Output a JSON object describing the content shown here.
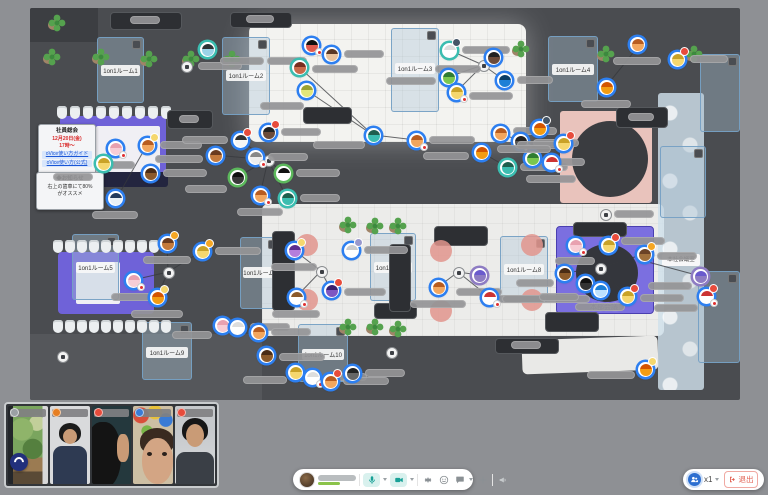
{
  "app": {
    "background": "#8e9094"
  },
  "map": {
    "floor_color": "#4a4c50",
    "rooms": [
      {
        "x": 67,
        "y": 29,
        "w": 45,
        "h": 64,
        "label": "1on1ルーム1"
      },
      {
        "x": 192,
        "y": 29,
        "w": 46,
        "h": 76,
        "label": "1on1ルーム2"
      },
      {
        "x": 361,
        "y": 20,
        "w": 46,
        "h": 82,
        "label": "1on1ルーム3"
      },
      {
        "x": 518,
        "y": 28,
        "w": 48,
        "h": 64,
        "label": "1on1ルーム4"
      },
      {
        "x": 42,
        "y": 226,
        "w": 45,
        "h": 64,
        "label": "1on1ルーム5"
      },
      {
        "x": 210,
        "y": 229,
        "w": 38,
        "h": 70,
        "label": "1on1ルーム6"
      },
      {
        "x": 340,
        "y": 225,
        "w": 44,
        "h": 66,
        "label": "1on1ルーム7"
      },
      {
        "x": 470,
        "y": 228,
        "w": 46,
        "h": 64,
        "label": "1on1ルーム8"
      },
      {
        "x": 112,
        "y": 314,
        "w": 48,
        "h": 56,
        "label": "1on1ルーム9"
      },
      {
        "x": 268,
        "y": 316,
        "w": 48,
        "h": 56,
        "label": "1on1ルーム10"
      },
      {
        "x": 670,
        "y": 46,
        "w": 38,
        "h": 76,
        "label": ""
      },
      {
        "x": 630,
        "y": 138,
        "w": 44,
        "h": 70,
        "label": ""
      },
      {
        "x": 668,
        "y": 263,
        "w": 40,
        "h": 90,
        "label": ""
      }
    ],
    "hq_room_label": "本社会議室",
    "meeting_label": "本部会議",
    "board1": {
      "l1": "社員総会",
      "l2": "12月20日(金)",
      "l3": "17時〜",
      "l4": "oVice使い方ガイド",
      "l5": "oVice使い方(公式)"
    },
    "board2": {
      "l1": "◆お知らせ",
      "l2": "右上の歯車にて80%",
      "l3": "がオススメ"
    },
    "plants": [
      [
        13,
        40
      ],
      [
        62,
        40
      ],
      [
        110,
        42
      ],
      [
        152,
        42
      ],
      [
        193,
        42
      ],
      [
        18,
        6
      ],
      [
        726,
        6
      ],
      [
        482,
        32
      ],
      [
        567,
        37
      ],
      [
        655,
        37
      ],
      [
        309,
        208
      ],
      [
        336,
        209
      ],
      [
        359,
        209
      ],
      [
        309,
        310
      ],
      [
        336,
        310
      ],
      [
        359,
        312
      ]
    ],
    "chair_rows": [
      [
        27,
        98,
        9,
        13
      ],
      [
        23,
        232,
        10,
        12
      ],
      [
        23,
        312,
        10,
        12
      ]
    ],
    "tables": [
      [
        80,
        4,
        70,
        16,
        20,
        4,
        30
      ],
      [
        200,
        4,
        60,
        14,
        16,
        3,
        28
      ],
      [
        137,
        102,
        44,
        17,
        12,
        5,
        20
      ],
      [
        273,
        99,
        47,
        15,
        0,
        0,
        0
      ],
      [
        586,
        99,
        50,
        19,
        12,
        6,
        26
      ],
      [
        543,
        214,
        52,
        13,
        0,
        0,
        0
      ],
      [
        404,
        218,
        52,
        18,
        0,
        0,
        0
      ],
      [
        344,
        295,
        41,
        14,
        0,
        0,
        0
      ],
      [
        515,
        304,
        52,
        18,
        0,
        0,
        0
      ],
      [
        465,
        330,
        62,
        14,
        16,
        3,
        30
      ],
      [
        242,
        223,
        21,
        78,
        0,
        0,
        0
      ],
      [
        359,
        236,
        20,
        66,
        0,
        0,
        0
      ]
    ],
    "pink_seats": [
      [
        266,
        226
      ],
      [
        266,
        281
      ],
      [
        400,
        232
      ],
      [
        400,
        292
      ],
      [
        491,
        226
      ],
      [
        491,
        281
      ]
    ],
    "spots": [
      [
        238,
        152
      ],
      [
        138,
        264
      ],
      [
        291,
        263
      ],
      [
        428,
        264
      ],
      [
        570,
        260
      ],
      [
        453,
        57
      ],
      [
        361,
        344
      ],
      [
        32,
        348
      ],
      [
        575,
        206
      ],
      [
        156,
        58
      ]
    ],
    "pills": [
      [
        168,
        54,
        44
      ],
      [
        584,
        202,
        40
      ],
      [
        465,
        287,
        95
      ]
    ],
    "avatar_fields": [
      "x",
      "y",
      "hair",
      "face",
      "ring",
      "badge",
      "mic",
      "pill_x",
      "pill_y",
      "pill_w"
    ],
    "avatars": [
      [
        177,
        41,
        "#2d3436",
        "#9bd3e8",
        "#3bbdb0",
        "",
        0,
        13,
        8,
        44
      ],
      [
        281,
        37,
        "#111111",
        "#e05b4e",
        "",
        "",
        1,
        -44,
        12,
        40
      ],
      [
        301,
        46,
        "#5a3825",
        "#e8c39e",
        "",
        "",
        0,
        13,
        -4,
        40
      ],
      [
        269,
        59,
        "#7a2e1f",
        "#c96a4a",
        "#3bbdb0",
        "",
        0,
        13,
        -2,
        46
      ],
      [
        276,
        82,
        "#9ba232",
        "#e3e77a",
        "",
        "",
        0,
        -46,
        12,
        44
      ],
      [
        238,
        124,
        "#222222",
        "#6b4b3a",
        "",
        "#e74c3c",
        0,
        13,
        -4,
        40
      ],
      [
        343,
        127,
        "#1e5f4e",
        "#3bbdb0",
        "",
        "",
        0,
        -60,
        6,
        52
      ],
      [
        386,
        132,
        "#b85c1f",
        "#f2a65e",
        "",
        "",
        1,
        13,
        -4,
        46
      ],
      [
        419,
        42,
        "#dddddd",
        "#ffffff",
        "#3bbdb0",
        "#445566",
        0,
        13,
        -4,
        48
      ],
      [
        463,
        49,
        "#222222",
        "#6b4b3a",
        "",
        "",
        0,
        -58,
        8,
        46
      ],
      [
        418,
        69,
        "#2f7d32",
        "#7ac74f",
        "",
        "",
        0,
        -62,
        0,
        50
      ],
      [
        426,
        84,
        "#c9a227",
        "#f5d76e",
        "",
        "",
        1,
        13,
        0,
        44
      ],
      [
        474,
        72,
        "#0b3d66",
        "#1d7fd6",
        "",
        "",
        0,
        13,
        -4,
        36
      ],
      [
        85,
        140,
        "#e8a1b0",
        "#f7cdd6",
        "",
        "",
        1,
        -20,
        13,
        40
      ],
      [
        117,
        137,
        "#b85c1f",
        "#f2a65e",
        "",
        "#f5d76e",
        0,
        13,
        -4,
        42
      ],
      [
        73,
        155,
        "#c9a227",
        "#f5d76e",
        "#3bbdb0",
        "",
        0,
        -50,
        10,
        40
      ],
      [
        120,
        165,
        "#4a2c16",
        "#8b5a2b",
        "",
        "",
        0,
        13,
        -4,
        44
      ],
      [
        85,
        190,
        "#223a5e",
        "#e8f0f7",
        "",
        "",
        0,
        -23,
        13,
        46
      ],
      [
        210,
        132,
        "#333333",
        "#f5f5f5",
        "",
        "#e74c3c",
        0,
        -58,
        -4,
        46
      ],
      [
        185,
        147,
        "#6b3b1f",
        "#c47a3d",
        "",
        "",
        0,
        -60,
        0,
        48
      ],
      [
        225,
        149,
        "#888888",
        "#eeeeee",
        "",
        "",
        1,
        13,
        -4,
        40
      ],
      [
        207,
        169,
        "#111111",
        "#3a3a3a",
        "#5cb85c",
        "",
        0,
        -52,
        8,
        42
      ],
      [
        253,
        165,
        "#111111",
        "#ffffff",
        "#5cb85c",
        "",
        0,
        13,
        -4,
        44
      ],
      [
        230,
        187,
        "#b85c1f",
        "#f2a65e",
        "",
        "",
        1,
        -23,
        13,
        46
      ],
      [
        257,
        190,
        "#1e5f4e",
        "#3bbdb0",
        "#3bbdb0",
        "",
        0,
        13,
        -4,
        40
      ],
      [
        607,
        36,
        "#b85c1f",
        "#f2a65e",
        "",
        "",
        0,
        -24,
        13,
        48
      ],
      [
        647,
        51,
        "#c9a227",
        "#f5d76e",
        "",
        "#e74c3c",
        0,
        13,
        -4,
        38
      ],
      [
        576,
        79,
        "#d35400",
        "#f39c12",
        "",
        "",
        0,
        -25,
        13,
        50
      ],
      [
        470,
        125,
        "#b85c1f",
        "#f2a65e",
        "",
        "",
        0,
        13,
        -6,
        44
      ],
      [
        490,
        133,
        "#222222",
        "#555555",
        "",
        "",
        1,
        13,
        -2,
        46
      ],
      [
        451,
        144,
        "#d35400",
        "#f39c12",
        "",
        "",
        0,
        -58,
        0,
        46
      ],
      [
        477,
        159,
        "#1e5f4e",
        "#3bbdb0",
        "#3bbdb0",
        "",
        0,
        13,
        -4,
        48
      ],
      [
        502,
        150,
        "#2f7d32",
        "#7ac74f",
        "",
        "",
        0,
        13,
        0,
        40
      ],
      [
        509,
        120,
        "#d35400",
        "#f39c12",
        "",
        "#445566",
        0,
        -22,
        13,
        44
      ],
      [
        533,
        135,
        "#c9a227",
        "#f5d76e",
        "",
        "#e74c3c",
        0,
        -66,
        2,
        54
      ],
      [
        521,
        154,
        "#cc3333",
        "#ffffff",
        "",
        "",
        1,
        -25,
        13,
        50
      ],
      [
        137,
        235,
        "#6b3b1f",
        "#c47a3d",
        "",
        "#f5a623",
        0,
        -24,
        13,
        48
      ],
      [
        172,
        243,
        "#c9a227",
        "#f5d76e",
        "",
        "#f5a623",
        0,
        13,
        -4,
        46
      ],
      [
        103,
        272,
        "#e8a1b0",
        "#f7cdd6",
        "",
        "",
        1,
        -22,
        13,
        44
      ],
      [
        127,
        289,
        "#d35400",
        "#f39c12",
        "",
        "#f5d76e",
        0,
        -26,
        13,
        52
      ],
      [
        192,
        317,
        "#e8a1b0",
        "#f7cdd6",
        "",
        "",
        0,
        -50,
        6,
        40
      ],
      [
        207,
        319,
        "#dddddd",
        "#ffffff",
        "",
        "",
        0,
        13,
        -4,
        40
      ],
      [
        264,
        242,
        "#5b2d8e",
        "#b57edc",
        "",
        "#f5d76e",
        0,
        -23,
        13,
        46
      ],
      [
        321,
        242,
        "#cccccc",
        "#ffffff",
        "",
        "#9999cc",
        0,
        13,
        -4,
        44
      ],
      [
        266,
        289,
        "#8b5a2b",
        "#ffffff",
        "",
        "",
        1,
        -24,
        13,
        48
      ],
      [
        301,
        282,
        "#3a1f6e",
        "#7e57c2",
        "",
        "#e74c3c",
        0,
        13,
        -2,
        42
      ],
      [
        408,
        279,
        "#b85c1f",
        "#f2a65e",
        "",
        "",
        0,
        -28,
        13,
        56
      ],
      [
        449,
        267,
        "#6a5acd",
        "#8e7cc3",
        "#8e7cc3",
        "",
        0,
        -23,
        13,
        46
      ],
      [
        459,
        289,
        "#cc3333",
        "#ffffff",
        "",
        "",
        1,
        13,
        -2,
        44
      ],
      [
        228,
        324,
        "#b85c1f",
        "#f2a65e",
        "",
        "",
        0,
        13,
        -4,
        40
      ],
      [
        236,
        347,
        "#4a2c16",
        "#8b5a2b",
        "",
        "",
        0,
        13,
        -2,
        46
      ],
      [
        265,
        364,
        "#c9a227",
        "#f5d76e",
        "",
        "",
        0,
        -52,
        4,
        44
      ],
      [
        282,
        369,
        "#dddddd",
        "#ffffff",
        "",
        "",
        1,
        13,
        -4,
        42
      ],
      [
        300,
        373,
        "#b85c1f",
        "#f2a65e",
        "",
        "#e74c3c",
        0,
        13,
        -4,
        46
      ],
      [
        322,
        365,
        "#222222",
        "#666666",
        "",
        "",
        0,
        13,
        -4,
        40
      ],
      [
        545,
        237,
        "#e8a1b0",
        "#f7cdd6",
        "",
        "",
        1,
        -20,
        12,
        40
      ],
      [
        578,
        237,
        "#c9a227",
        "#f5d76e",
        "",
        "#e74c3c",
        0,
        13,
        -8,
        44
      ],
      [
        614,
        246,
        "#6b4226",
        "#a0703c",
        "",
        "#f5a623",
        0,
        13,
        -2,
        40
      ],
      [
        534,
        265,
        "#4a2c16",
        "#8b5a2b",
        "",
        "",
        0,
        -48,
        6,
        38
      ],
      [
        555,
        275,
        "#111111",
        "#333333",
        "",
        "",
        0,
        -46,
        10,
        40
      ],
      [
        570,
        282,
        "#1d7fd6",
        "#bde0fe",
        "",
        "",
        0,
        -25,
        13,
        50
      ],
      [
        597,
        288,
        "#c9a227",
        "#f5d76e",
        "",
        "#e74c3c",
        0,
        13,
        -2,
        44
      ],
      [
        670,
        268,
        "#6a5acd",
        "#8e7cc3",
        "#8e7cc3",
        "",
        0,
        -52,
        6,
        44
      ],
      [
        676,
        288,
        "#cc3333",
        "#ffffff",
        "",
        "#e74c3c",
        1,
        -52,
        8,
        44
      ],
      [
        615,
        361,
        "#d35400",
        "#f39c12",
        "",
        "#f5d76e",
        0,
        -58,
        2,
        48
      ]
    ],
    "lines": [
      [
        269,
        59,
        343,
        127
      ],
      [
        276,
        82,
        343,
        127
      ],
      [
        343,
        127,
        386,
        132
      ],
      [
        453,
        57,
        419,
        42
      ],
      [
        453,
        57,
        463,
        49
      ],
      [
        453,
        57,
        418,
        69
      ],
      [
        453,
        57,
        426,
        84
      ],
      [
        453,
        57,
        474,
        72
      ],
      [
        607,
        40,
        578,
        76
      ],
      [
        238,
        152,
        210,
        132
      ],
      [
        238,
        152,
        185,
        147
      ],
      [
        238,
        152,
        225,
        149
      ],
      [
        238,
        152,
        207,
        169
      ],
      [
        238,
        152,
        253,
        165
      ],
      [
        238,
        152,
        230,
        187
      ],
      [
        238,
        152,
        257,
        190
      ],
      [
        117,
        137,
        88,
        188
      ],
      [
        138,
        264,
        137,
        235
      ],
      [
        138,
        264,
        172,
        243
      ],
      [
        138,
        264,
        103,
        272
      ],
      [
        138,
        264,
        127,
        289
      ],
      [
        291,
        263,
        264,
        242
      ],
      [
        291,
        263,
        301,
        282
      ],
      [
        291,
        263,
        266,
        289
      ],
      [
        428,
        264,
        408,
        279
      ],
      [
        428,
        264,
        449,
        267
      ],
      [
        428,
        264,
        459,
        289
      ],
      [
        570,
        260,
        545,
        237
      ],
      [
        570,
        260,
        578,
        237
      ],
      [
        570,
        260,
        614,
        246
      ],
      [
        570,
        260,
        534,
        265
      ],
      [
        570,
        260,
        555,
        275
      ],
      [
        570,
        260,
        570,
        282
      ],
      [
        570,
        260,
        597,
        288
      ],
      [
        670,
        268,
        618,
        254
      ],
      [
        470,
        125,
        490,
        133
      ],
      [
        451,
        144,
        477,
        159
      ]
    ]
  },
  "videos": {
    "tiles": [
      {
        "kind": "k1",
        "icon": "#9aa0a4"
      },
      {
        "kind": "k2",
        "icon": "#e67e22"
      },
      {
        "kind": "k3",
        "icon": "#e74c3c"
      },
      {
        "kind": "k4",
        "icon": "#3a7bd5"
      },
      {
        "kind": "k5",
        "icon": "#e74c3c"
      }
    ]
  },
  "toolbar": {
    "mic": "microphone",
    "camera": "camera",
    "settings": "gear",
    "reaction": "smiley",
    "chat": "speech-bubble",
    "add": "plus",
    "megaphone": "megaphone"
  },
  "zoom_control": {
    "level": "x1",
    "leave_label": "退出"
  }
}
